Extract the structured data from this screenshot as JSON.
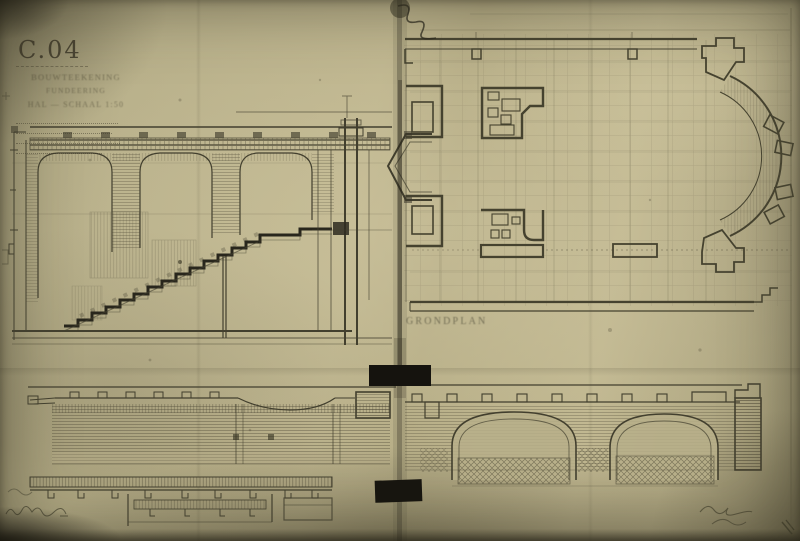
{
  "colors": {
    "paper": "#b6ae88",
    "paper_light": "#c8bf99",
    "paper_dark": "#8a8465",
    "ink": "#3b382a",
    "faint_ink": "#6e6850",
    "tape": "#15130e"
  },
  "title_block": {
    "number": "C.04",
    "line1": "BOUWTEEKENING",
    "line2": "FUNDEERING",
    "line3": "HAL — SCHAAL 1:50"
  },
  "labels": {
    "plan_label": "GRONDPLAN"
  }
}
